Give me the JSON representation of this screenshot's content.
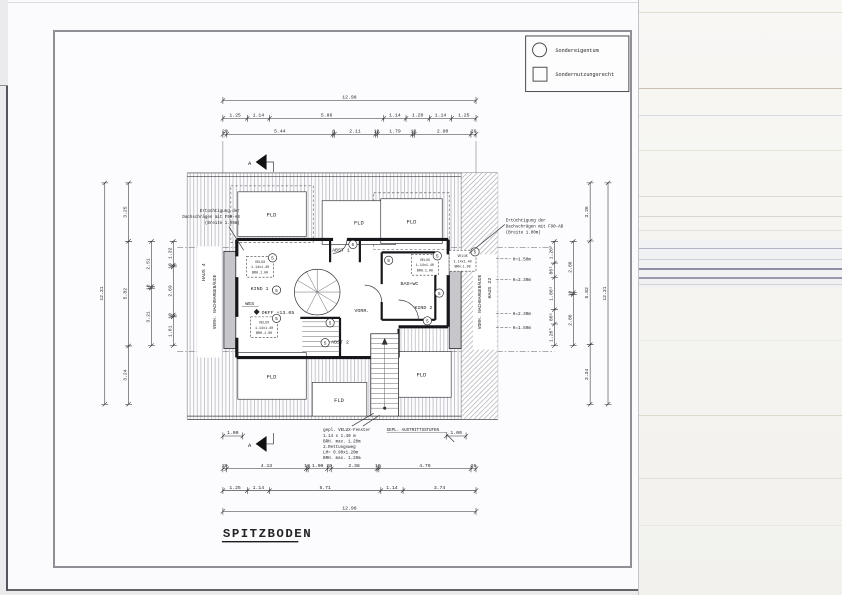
{
  "title": "SPITZBODEN",
  "legend": {
    "item1": "Sondereigentum",
    "item2": "Sondernutzungsrecht"
  },
  "plan": {
    "fld": "FLD",
    "abst1": "ABST 1",
    "abst2": "ABST 2",
    "kind1": "KIND 1",
    "kind2": "KIND 2",
    "wes": "WES",
    "vorr": "VORR.",
    "bad_wc": "BAD+WC",
    "okff": "OKFF +13.05",
    "marker": "5",
    "haus4": "HAUS 4",
    "haus22": "HAUS 22",
    "neighbor_left": "VERH. NACHBARGEBÄUDE",
    "neighbor_right": "VORH. NACHBARGEBÄUDE",
    "section": "A"
  },
  "annotations": {
    "left": [
      "Ertüchtigung der",
      "Dachschrägen mit F90-AB",
      "(Breite 1.00m)"
    ],
    "right": [
      "Ertüchtigung der",
      "Dachschrägen mit F90-AB",
      "(Breite 1.00m)"
    ],
    "velux": [
      "VELUX",
      "1.14x1.40",
      "BRH.1.00"
    ],
    "window_note": [
      "gepl. VELUX-Fenster",
      "1.14 x 1.40 m",
      "BRH. max. 1.20m",
      "2.Rettungsweg",
      "LM= 0.90x1.20m",
      "BRH. max. 1.20m"
    ],
    "steps_note": "GEPL. AUSTRITTSSTUFEN",
    "heights": [
      "H=1.50m",
      "H=2.30m",
      "H=2.30m",
      "H=1.50m"
    ]
  },
  "dims": {
    "top_total": [
      {
        "t": "12.98",
        "m": 12.98
      }
    ],
    "top_row2": [
      {
        "t": "1.25",
        "m": 1.25
      },
      {
        "t": "1.14",
        "m": 1.14
      },
      {
        "t": "5.86",
        "m": 5.86
      },
      {
        "t": "1.14",
        "m": 1.14
      },
      {
        "t": "1.20",
        "m": 1.2
      },
      {
        "t": "1.14",
        "m": 1.14
      },
      {
        "t": "1.25",
        "m": 1.25
      }
    ],
    "top_row3": [
      {
        "t": "20",
        "m": 0.2
      },
      {
        "t": "5.44",
        "m": 5.44
      },
      {
        "t": "8",
        "m": 0.08
      },
      {
        "t": "2.11",
        "m": 2.11
      },
      {
        "t": "10",
        "m": 0.1
      },
      {
        "t": "1.79",
        "m": 1.79
      },
      {
        "t": "10",
        "m": 0.1
      },
      {
        "t": "2.90",
        "m": 2.9
      },
      {
        "t": "26",
        "m": 0.26
      }
    ],
    "bottom_row1": [
      {
        "t": "20",
        "m": 0.2
      },
      {
        "t": "4.13",
        "m": 4.13
      },
      {
        "t": "10",
        "m": 0.1
      },
      {
        "t": "1.00",
        "m": 1.0
      },
      {
        "t": "20",
        "m": 0.2
      },
      {
        "t": "2.38",
        "m": 2.38
      },
      {
        "t": "10",
        "m": 0.1
      },
      {
        "t": "4.79",
        "m": 4.79
      },
      {
        "t": "26",
        "m": 0.26
      }
    ],
    "bottom_row2": [
      {
        "t": "1.25",
        "m": 1.25
      },
      {
        "t": "1.14",
        "m": 1.14
      },
      {
        "t": "5.71",
        "m": 5.71
      },
      {
        "t": "1.14",
        "m": 1.14
      },
      {
        "t": "3.74",
        "m": 3.74
      }
    ],
    "bottom_total": [
      {
        "t": "12.98",
        "m": 12.98
      }
    ],
    "left_outer": [
      {
        "t": "12.31",
        "m": 12.31
      }
    ],
    "left_a": [
      {
        "t": "3.25",
        "m": 3.25
      },
      {
        "t": "5.82",
        "m": 5.82
      },
      {
        "t": "3.24",
        "m": 3.24
      }
    ],
    "left_b": [
      {
        "t": "2.51",
        "m": 2.51
      },
      {
        "t": "10",
        "m": 0.1
      },
      {
        "t": "3.21",
        "m": 3.21
      }
    ],
    "left_c": [
      {
        "t": "1.32",
        "m": 1.32
      },
      {
        "t": "10",
        "m": 0.1
      },
      {
        "t": "2.69",
        "m": 2.69
      },
      {
        "t": "10",
        "m": 0.1
      },
      {
        "t": "1.61",
        "m": 1.61
      }
    ],
    "right_outer": [
      {
        "t": "12.31",
        "m": 12.31
      }
    ],
    "right_a": [
      {
        "t": "3.26",
        "m": 3.26
      },
      {
        "t": "5.82",
        "m": 5.82
      },
      {
        "t": "3.34",
        "m": 3.34
      }
    ],
    "right_b": [
      {
        "t": "2.86",
        "m": 2.86
      },
      {
        "t": "10",
        "m": 0.1
      },
      {
        "t": "2.86",
        "m": 2.86
      }
    ],
    "right_c": [
      {
        "t": "1.20⁵",
        "m": 1.205
      },
      {
        "t": "80¹",
        "m": 0.8
      },
      {
        "t": "1.80¹",
        "m": 1.8
      },
      {
        "t": "80¹",
        "m": 0.8
      },
      {
        "t": "1.20⁵",
        "m": 1.205
      }
    ],
    "one": [
      {
        "t": "1.00",
        "m": 1.0
      }
    ]
  }
}
